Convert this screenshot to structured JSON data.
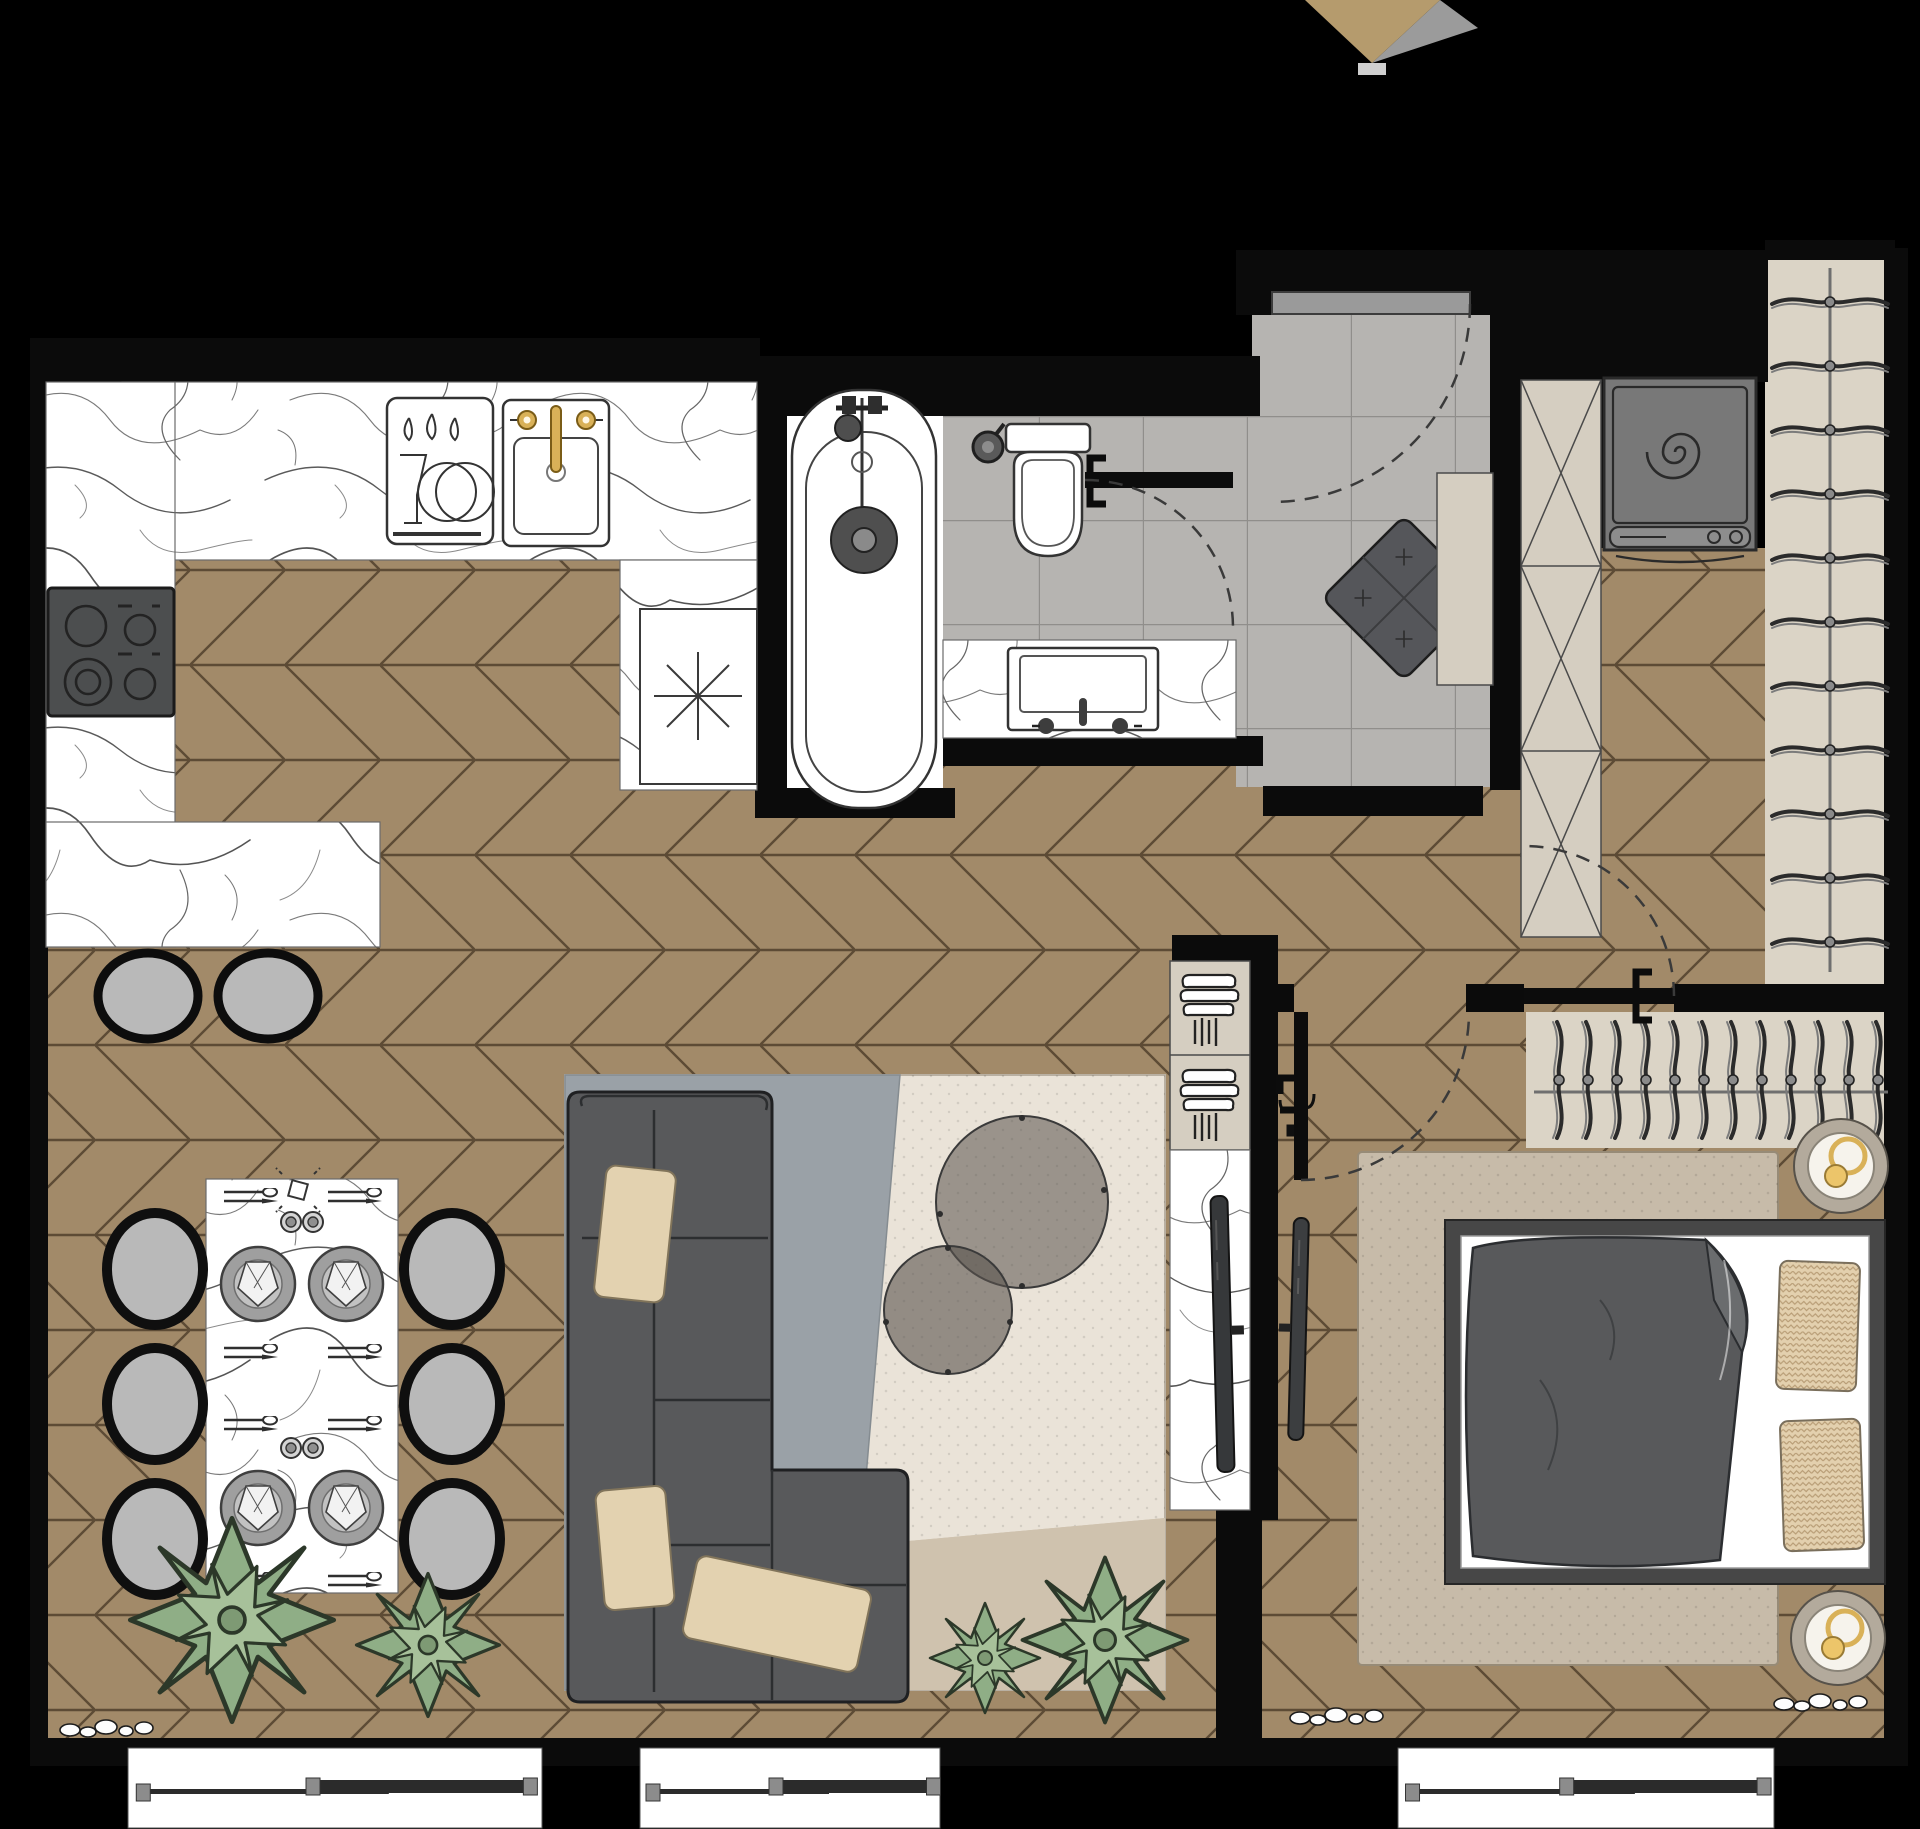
{
  "meta": {
    "kind": "interior-floor-plan-render",
    "view": "top-down",
    "no_visible_text": true
  },
  "palette": {
    "background": "#000000",
    "wood": "#a28a69",
    "wood_line": "#5d4b35",
    "tile": "#b6b4b1",
    "tile_line": "#908e8b",
    "marble_white": "#ffffff",
    "marble_vein": "#555555",
    "wall": "#0b0b0b",
    "dark": "#58595b",
    "seat": "#b9b9b9",
    "beige_unit": "#d5cec1",
    "closet_floor": "#dbd4c6",
    "cream_rug": "#eae3d8",
    "rug_gray": "#9aa1a7",
    "rug_beige": "#cfc2ae",
    "bedroom_rug": "#c7bba9",
    "pillow": "#e3d2b0",
    "bed_pillow": "#e3d0ae",
    "plant": "#8fae86",
    "gold": "#d9b158",
    "marker_tan": "#b59b6d",
    "marker_shadow": "#9b9b9b"
  },
  "marker": {
    "points_tan": "1305,0 1440,0 1372,63",
    "points_shadow": "1440,0 1478,28 1372,63",
    "chip": {
      "x": 1358,
      "y": 63,
      "w": 28,
      "h": 12
    }
  },
  "windows": [
    {
      "x": 128,
      "w": 414
    },
    {
      "x": 640,
      "w": 300
    },
    {
      "x": 1398,
      "w": 376
    }
  ],
  "dining": {
    "chairs": [
      {
        "cx": 155,
        "cy": 1269
      },
      {
        "cx": 155,
        "cy": 1404
      },
      {
        "cx": 155,
        "cy": 1539
      },
      {
        "cx": 452,
        "cy": 1269
      },
      {
        "cx": 452,
        "cy": 1404
      },
      {
        "cx": 452,
        "cy": 1539
      }
    ],
    "plates": [
      {
        "cx": 258,
        "cy": 1284
      },
      {
        "cx": 346,
        "cy": 1284
      },
      {
        "cx": 258,
        "cy": 1508
      },
      {
        "cx": 346,
        "cy": 1508
      }
    ],
    "glass_pairs": [
      {
        "x": 280,
        "y": 1210
      },
      {
        "x": 280,
        "y": 1436
      }
    ],
    "cutlery": [
      {
        "x": 222,
        "y": 1188
      },
      {
        "x": 326,
        "y": 1188
      },
      {
        "x": 222,
        "y": 1344
      },
      {
        "x": 326,
        "y": 1344
      },
      {
        "x": 222,
        "y": 1416
      },
      {
        "x": 326,
        "y": 1416
      },
      {
        "x": 222,
        "y": 1572
      },
      {
        "x": 326,
        "y": 1572
      }
    ]
  },
  "island_stools": [
    {
      "cx": 148,
      "cy": 996
    },
    {
      "cx": 268,
      "cy": 996
    }
  ],
  "plants": [
    {
      "cx": 232,
      "cy": 1620,
      "s": 1.85
    },
    {
      "cx": 428,
      "cy": 1645,
      "s": 1.3
    },
    {
      "cx": 985,
      "cy": 1658,
      "s": 1.0
    },
    {
      "cx": 1105,
      "cy": 1640,
      "s": 1.5
    }
  ],
  "pebbles": [
    {
      "x": 58,
      "y": 1712
    },
    {
      "x": 1288,
      "y": 1700
    },
    {
      "x": 1772,
      "y": 1686
    }
  ],
  "closet_right": {
    "hanger_count": 11,
    "x": 1768,
    "y0": 288,
    "step": 64,
    "rod": {
      "x": 1830,
      "y1": 268,
      "y2": 972
    }
  },
  "closet_bedroom": {
    "hanger_count": 12,
    "x0": 1549,
    "step": 29,
    "y": 1018,
    "rod": {
      "y": 1092,
      "x1": 1534,
      "x2": 1888
    }
  },
  "hob_burners": 4,
  "coffee_tables": 2,
  "bed_pillows": 2,
  "sofa_pillows": 3,
  "book_shelf_cells": 2,
  "doors": 4,
  "icons": {
    "washing-machine-icon": "square-with-spiral-drum",
    "hanger-icon": "curved-clothes-hanger",
    "dish-rack-icon": "drops-glass-and-plates",
    "sink-icon": "basin-with-gold-faucet",
    "hob-icon": "four-burner-cooktop",
    "toilet-icon": "wall-hung-bowl",
    "bathtub-icon": "oval-tub-with-shower",
    "plant-icon": "succulent-rosette",
    "candle-icon": "dashed-square-flame",
    "tv-icon": "thin-screen-bar",
    "lamp-icon": "round-shade-gold-rings",
    "marker-icon": "downward-tan-arrow"
  }
}
